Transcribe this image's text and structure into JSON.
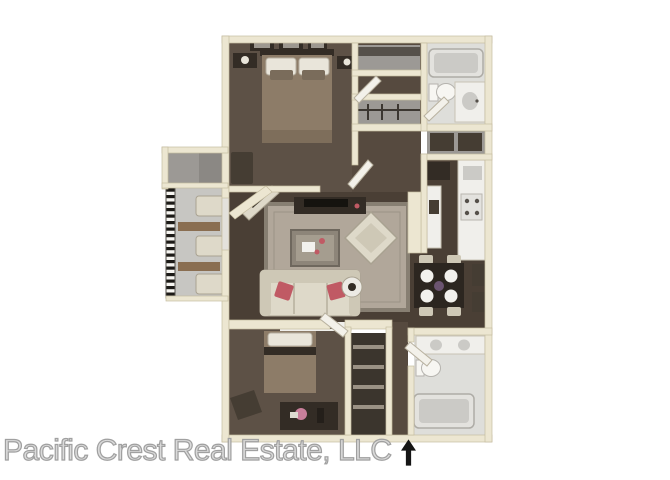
{
  "image": {
    "type": "3d-floorplan",
    "description": "Top-down 3D rendering of a two-bedroom, two-bathroom apartment floor plan with balcony",
    "bedrooms": 2,
    "bathrooms": 2
  },
  "watermark": {
    "text": "Pacific Crest Real Estate, LLC",
    "arrow_icon": "north-up-arrow"
  },
  "rooms": [
    {
      "name": "bedroom-1",
      "position": "top-left",
      "furniture": [
        "double-bed",
        "two-pillows",
        "headboard",
        "nightstand-left",
        "nightstand-right",
        "table-lamps",
        "three-wall-pictures",
        "bench"
      ]
    },
    {
      "name": "hall-closet",
      "position": "top-center",
      "furniture": [
        "shelf",
        "louvered-door"
      ]
    },
    {
      "name": "linen-closet",
      "position": "top-center",
      "furniture": [
        "hanging-rod"
      ]
    },
    {
      "name": "bathroom-1",
      "position": "top-right",
      "furniture": [
        "bathtub",
        "toilet",
        "vanity-sink"
      ]
    },
    {
      "name": "storage-closet-mid",
      "position": "right",
      "furniture": [
        "shelves"
      ]
    },
    {
      "name": "kitchen",
      "position": "right",
      "furniture": [
        "refrigerator",
        "counter",
        "sink",
        "stove"
      ]
    },
    {
      "name": "dining-area",
      "position": "right",
      "furniture": [
        "square-table",
        "four-place-settings",
        "four-chairs",
        "centerpiece",
        "wall-art"
      ]
    },
    {
      "name": "living-room",
      "position": "center",
      "furniture": [
        "area-rug",
        "sofa",
        "red-accent-pillows",
        "coffee-table",
        "armchair",
        "round-side-table",
        "tv-console",
        "angled-console",
        "sofa-table"
      ]
    },
    {
      "name": "balcony",
      "position": "left",
      "furniture": [
        "railing",
        "two-patio-chairs",
        "two-patio-tables",
        "storage-box"
      ]
    },
    {
      "name": "bedroom-2",
      "position": "bottom-left",
      "furniture": [
        "bed",
        "accent-chair",
        "dresser",
        "flower-vase",
        "bottle"
      ]
    },
    {
      "name": "closet-2",
      "position": "bottom-center",
      "furniture": [
        "shelves"
      ]
    },
    {
      "name": "bathroom-2",
      "position": "bottom-right",
      "furniture": [
        "double-vanity",
        "toilet",
        "bathtub"
      ]
    }
  ],
  "colors": {
    "background": "#ffffff",
    "wall": "#ece6d1",
    "wallStroke": "#c6bda0",
    "carpet": "#5d5146",
    "carpetDark": "#4a3f35",
    "corridorCarpet": "#564a3f",
    "rug": "#b1a79a",
    "rugBorder": "#877f72",
    "duvet": "#8d7c68",
    "pillowWhite": "#e9e5da",
    "furnitureCream": "#ded9c9",
    "furnitureShade": "#cec8b6",
    "woodDark": "#332c25",
    "darkAccent": "#453d33",
    "pillowRed": "#c05a64",
    "counter": "#f0efeb",
    "fixture": "#e3e2de",
    "fixtureShadow": "#cbcac6",
    "bathFloor": "#dededa",
    "balconyFloor": "#c7c6c2",
    "storageFloor": "#9c9995",
    "plateWhite": "#f2f1ed",
    "tableDark": "#2c2620",
    "centerpiece": "#6b5470",
    "flowerPink": "#c97f9b",
    "woodBrown": "#8a6e51",
    "white": "#f7f6f2",
    "doorFill": "#f3f1ea",
    "watermarkStroke": "#a0a0a0",
    "arrow": "#151515"
  }
}
